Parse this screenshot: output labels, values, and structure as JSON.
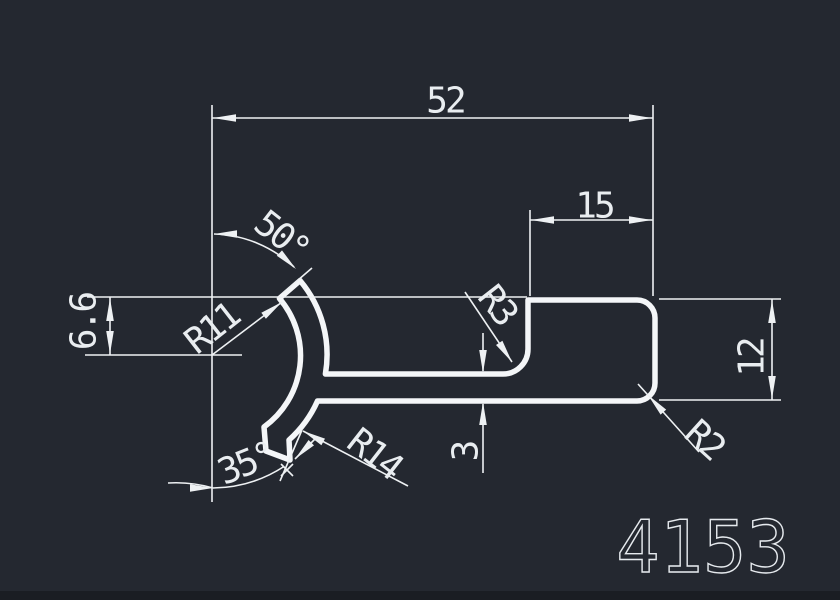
{
  "drawing": {
    "part_number": "4153",
    "background_color": "#242830",
    "line_color": "#eef1f3",
    "dimensions": {
      "width_total": "52",
      "width_step": "15",
      "height_left": "6.6",
      "height_right": "12",
      "web_thickness": "3",
      "angle_top": "50°",
      "angle_bottom": "35°",
      "radius_inner": "R11",
      "radius_outer": "R14",
      "radius_fillet": "R3",
      "radius_corner": "R2"
    }
  }
}
